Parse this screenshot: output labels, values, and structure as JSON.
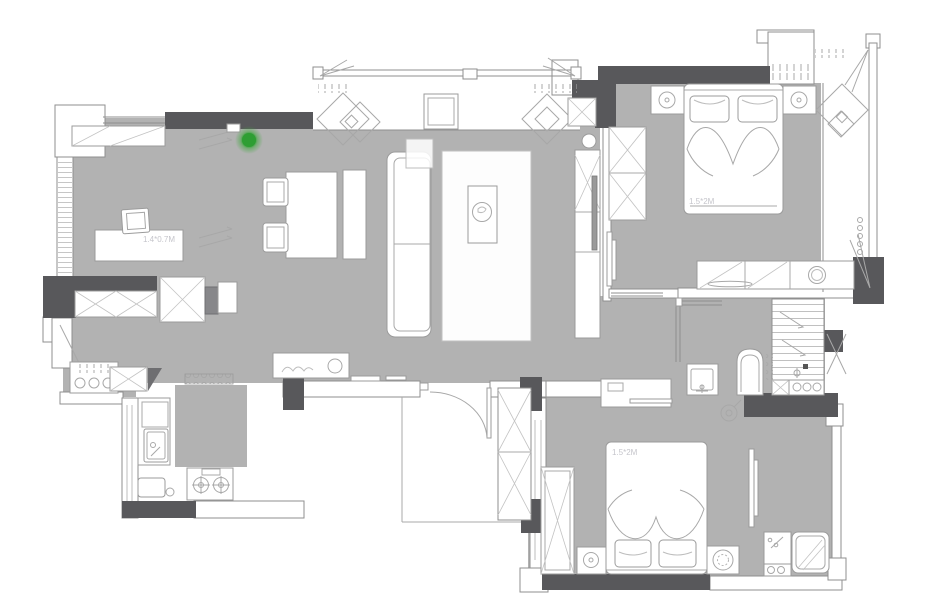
{
  "plan": {
    "type": "apartment-floor-plan",
    "labels": {
      "study_desk_size": "1.4*0.7M",
      "master_bed_size": "1.5*2M",
      "second_bed_size": "1.5*2M"
    },
    "colors": {
      "floor_gray": "#b2b2b2",
      "wall_dark": "#58585b",
      "room_white": "#ffffff",
      "furniture_line": "#9b9b9b",
      "label_text": "#c5c5cb",
      "marker_green": "#2e9e33"
    },
    "marker": {
      "label": "green-status-marker",
      "color": "#2e9e33"
    }
  }
}
